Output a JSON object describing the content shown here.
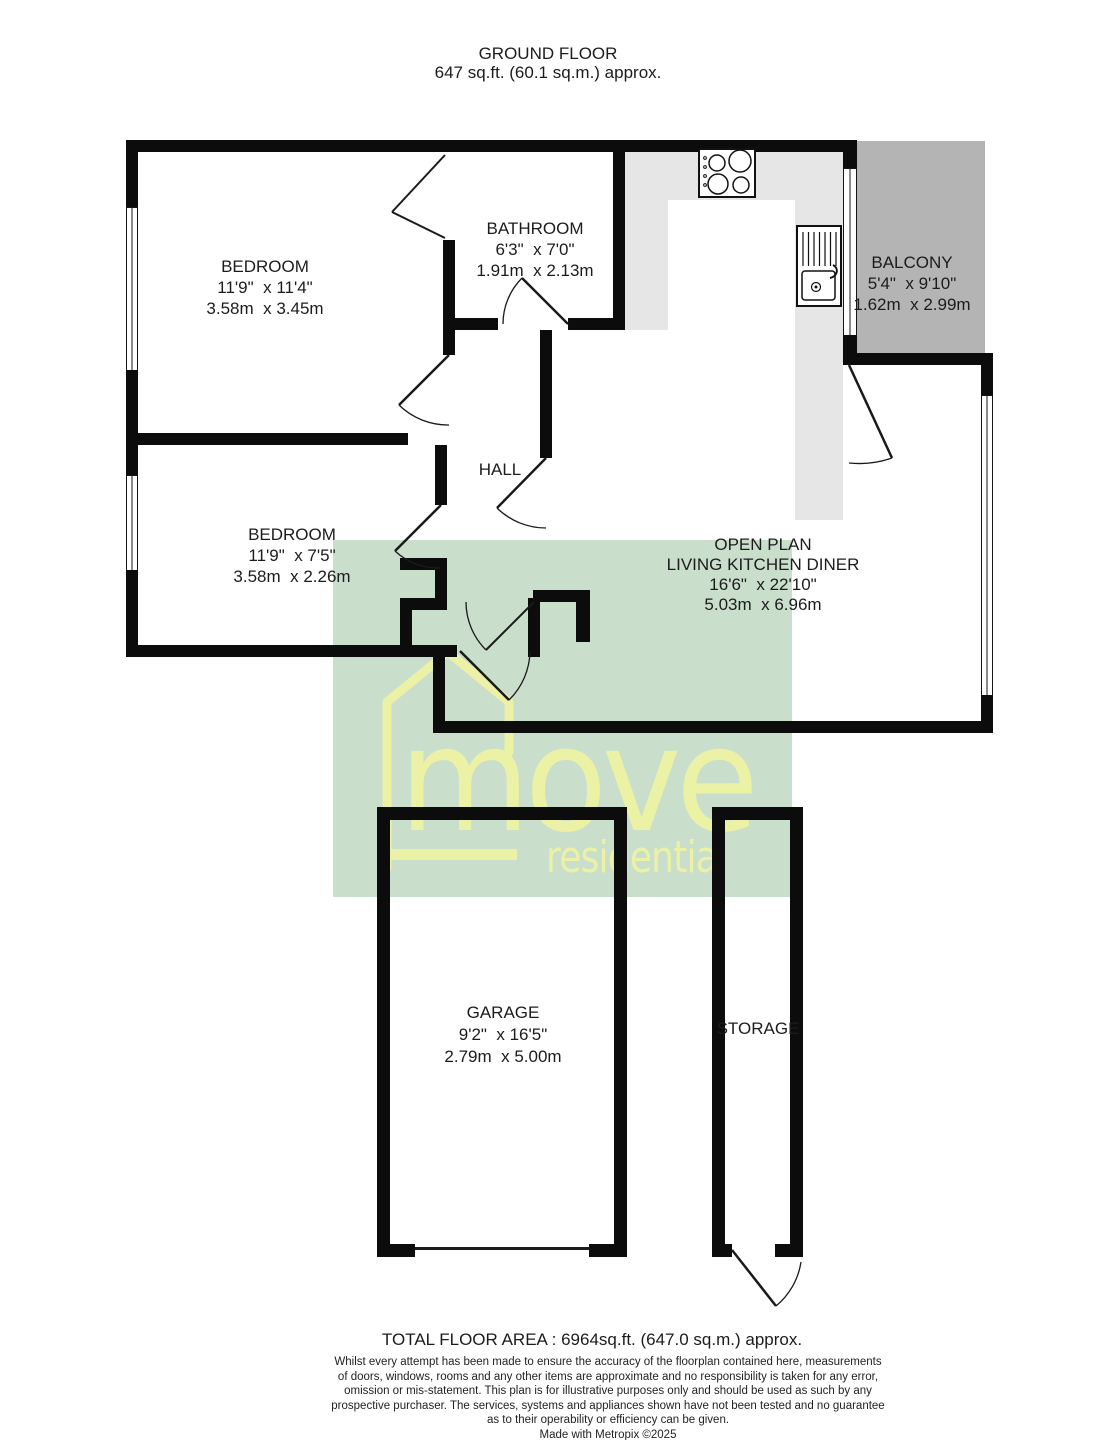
{
  "title": {
    "line1": "GROUND FLOOR",
    "line2": "647 sq.ft. (60.1 sq.m.) approx."
  },
  "rooms": {
    "bedroom1": {
      "name": "BEDROOM",
      "imperial": "11'9\"  x 11'4\"",
      "metric": "3.58m  x 3.45m"
    },
    "bathroom": {
      "name": "BATHROOM",
      "imperial": "6'3\"  x 7'0\"",
      "metric": "1.91m  x 2.13m"
    },
    "balcony": {
      "name": "BALCONY",
      "imperial": "5'4\"  x 9'10\"",
      "metric": "1.62m  x 2.99m"
    },
    "bedroom2": {
      "name": "BEDROOM",
      "imperial": "11'9\"  x 7'5\"",
      "metric": "3.58m  x 2.26m"
    },
    "hall": {
      "name": "HALL"
    },
    "openplan": {
      "name_line1": "OPEN PLAN",
      "name_line2": "LIVING KITCHEN DINER",
      "imperial": "16'6\"  x 22'10\"",
      "metric": "5.03m  x 6.96m"
    },
    "garage": {
      "name": "GARAGE",
      "imperial": "9'2\"  x 16'5\"",
      "metric": "2.79m  x 5.00m"
    },
    "storage": {
      "name": "STORAGE"
    }
  },
  "watermark": {
    "brand": "move",
    "brand_sub": "residential"
  },
  "footer": {
    "total": "TOTAL FLOOR AREA : 6964sq.ft. (647.0 sq.m.) approx.",
    "disclaimer_line1": "Whilst every attempt has been made to ensure the accuracy of the floorplan contained here, measurements",
    "disclaimer_line2": "of doors, windows, rooms and any other items are approximate and no responsibility is taken for any error,",
    "disclaimer_line3": "omission or mis-statement. This plan is for illustrative purposes only and should be used as such by any",
    "disclaimer_line4": "prospective purchaser. The services, systems and appliances shown have not been tested and no guarantee",
    "disclaimer_line5": "as to their operability or efficiency can be given.",
    "credit": "Made with Metropix ©2025"
  },
  "colors": {
    "wall": "#0c0c0c",
    "balcony_fill": "#b4b4b4",
    "counter_fill": "#e6e6e6",
    "watermark_green": "#c6dcc8",
    "logo_yellow": "#eef3a2",
    "text": "#1c1c1c"
  }
}
